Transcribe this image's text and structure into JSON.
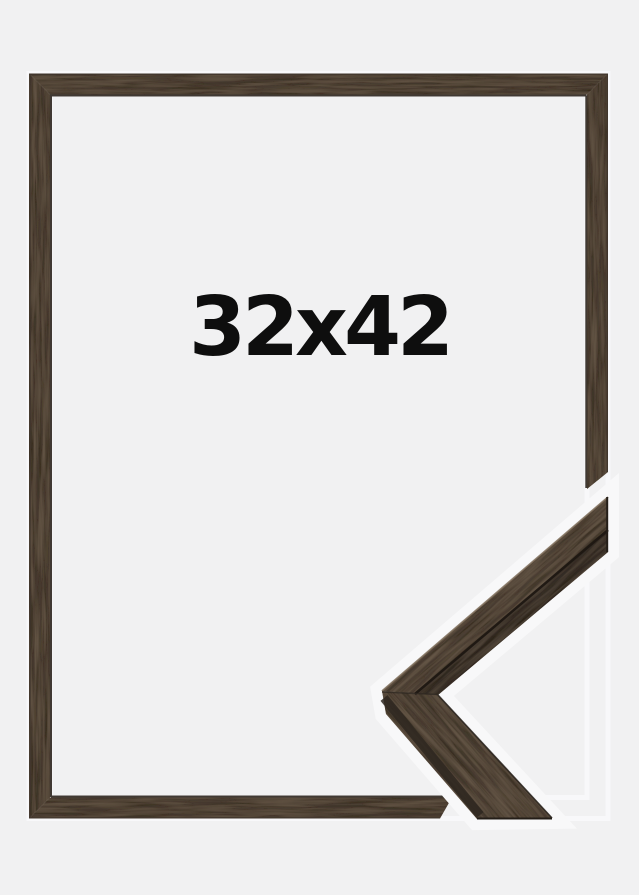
{
  "product": {
    "size_label": "32x42"
  },
  "colors": {
    "background": "#f1f1f2",
    "wood_base": "#564839",
    "sample_base": "#5a4c3d",
    "wood_side": "#3a3128",
    "wood_dark_streak": "#241d16",
    "wood_light_streak": "#8d7c68",
    "inner_lip": "#2b241d",
    "halo": "#f8f8f9",
    "label_color": "#0e0e0e"
  }
}
